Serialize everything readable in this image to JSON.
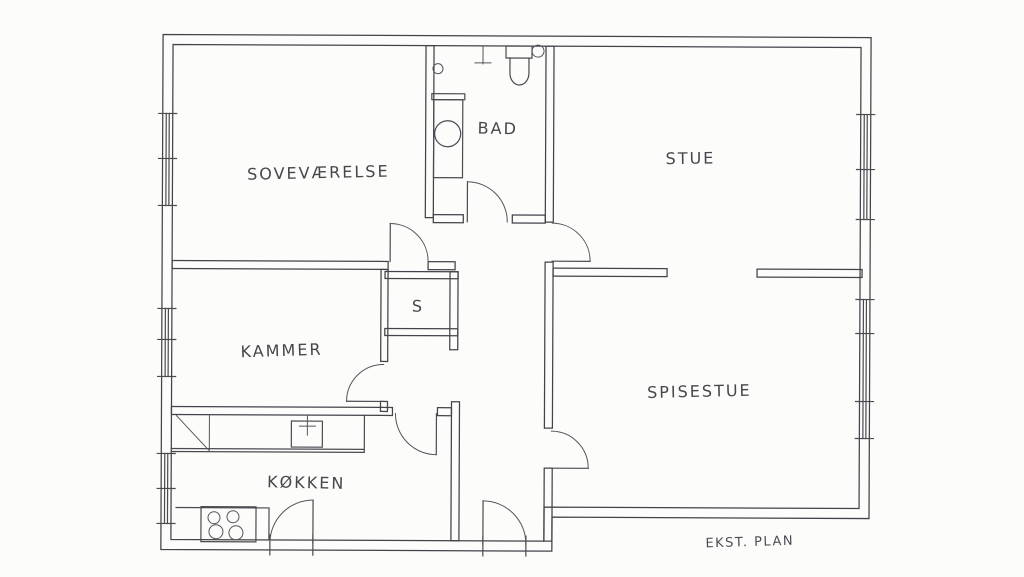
{
  "drawing": {
    "type": "hand-drawn floor plan",
    "caption": "EKST. PLAN",
    "line_color": "#4a4a50",
    "paper_color": "#fcfcfa"
  },
  "rooms": [
    {
      "id": "sovevaerelse",
      "label": "SOVEVÆRELSE"
    },
    {
      "id": "bad",
      "label": "BAD"
    },
    {
      "id": "stue",
      "label": "STUE"
    },
    {
      "id": "kammer",
      "label": "KAMMER"
    },
    {
      "id": "skab",
      "label": "S"
    },
    {
      "id": "spisestue",
      "label": "SPISESTUE"
    },
    {
      "id": "koekken",
      "label": "KØKKEN"
    }
  ]
}
